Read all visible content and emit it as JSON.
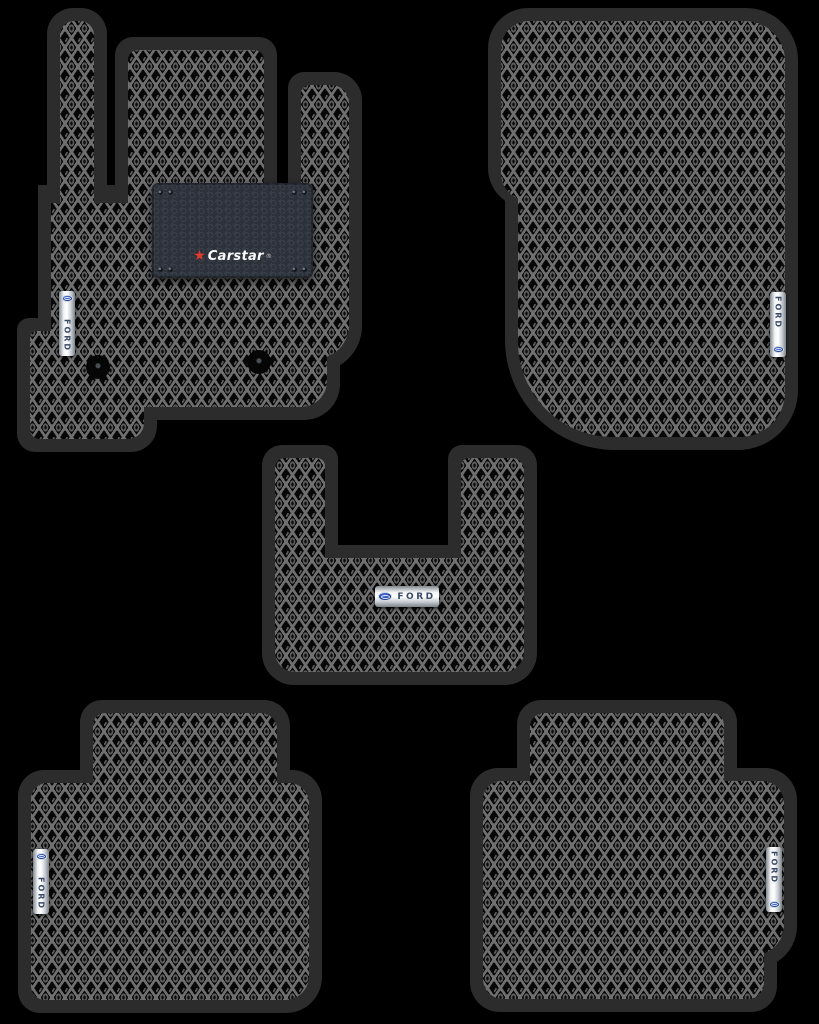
{
  "scene": {
    "type": "product-photo",
    "subject": "Set of 5 black EVA rhombus-pattern car floor mats with black trim on a black background",
    "background_color": "#000000"
  },
  "branding": {
    "ford_badge_text": "FORD",
    "carstar_brand": "Carstar",
    "registered_mark": "®",
    "star_glyph": "★"
  },
  "colors": {
    "background": "#000000",
    "mat_trim": "#2c2c2c",
    "pattern_line": "#6f6f6f",
    "pattern_base": "#070707",
    "patch_background": "#2c313a",
    "badge_silver": "#f2f4f6",
    "ford_blue": "#1b3d8f",
    "carstar_red": "#e23b2e"
  },
  "mats": [
    {
      "id": "front-driver",
      "position": "top-left",
      "badge_text": "FORD",
      "badge_orientation": "vertical",
      "extras": [
        "Carstar patch",
        "2 fastener clips"
      ]
    },
    {
      "id": "front-passenger",
      "position": "top-right",
      "badge_text": "FORD",
      "badge_orientation": "vertical",
      "extras": []
    },
    {
      "id": "tunnel",
      "position": "middle-center",
      "badge_text": "FORD",
      "badge_orientation": "horizontal",
      "extras": []
    },
    {
      "id": "rear-left",
      "position": "bottom-left",
      "badge_text": "FORD",
      "badge_orientation": "vertical",
      "extras": []
    },
    {
      "id": "rear-right",
      "position": "bottom-right",
      "badge_text": "FORD",
      "badge_orientation": "vertical",
      "extras": []
    }
  ]
}
